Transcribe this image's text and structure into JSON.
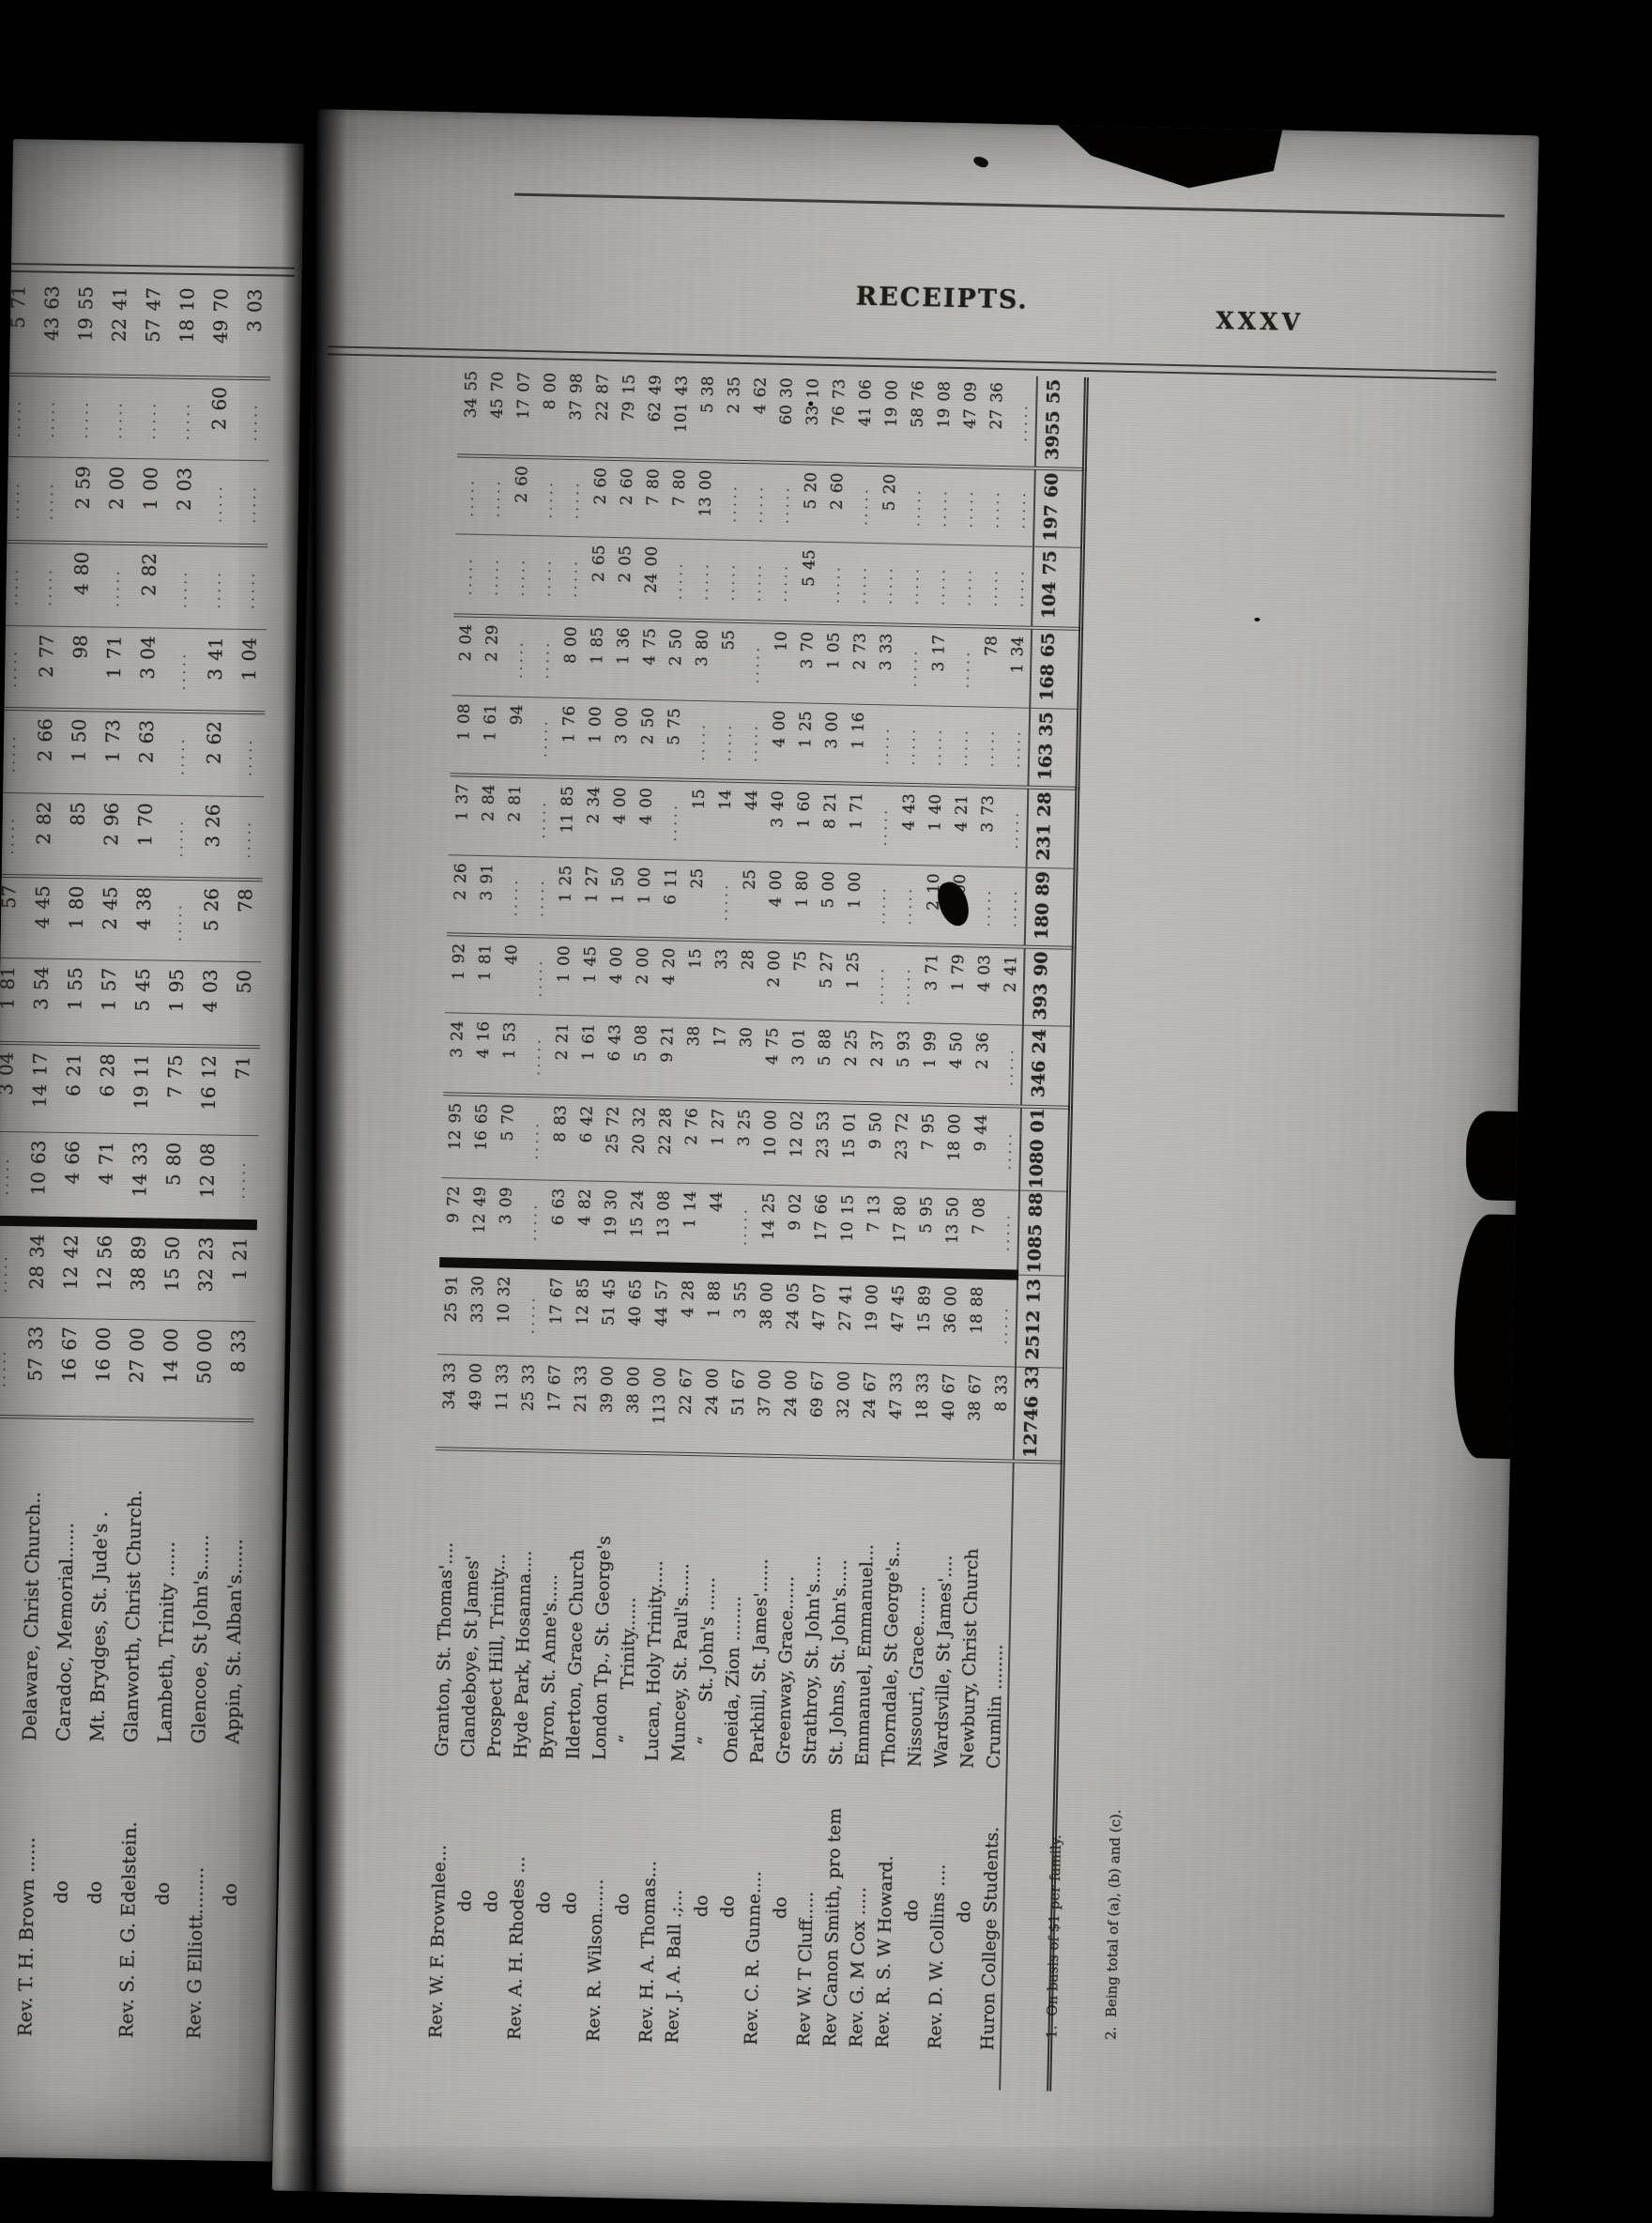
{
  "header": {
    "running_title": "RECEIPTS.",
    "folio": "XXXV"
  },
  "colors": {
    "paper": "#b3b2ae",
    "ink": "#29241e",
    "background": "#020202",
    "heavy_bar": "#12100c"
  },
  "right_page": {
    "rows": [
      {
        "clergy": "Rev. W. F. Brownlee...",
        "church": "Granton, St. Thomas'....",
        "values": [
          "34 33",
          "25 91",
          "9 72",
          "12 95",
          "3 24",
          "1 92",
          "2 26",
          "1 37",
          "1 08",
          "2 04",
          "",
          "",
          "34 55"
        ]
      },
      {
        "clergy": "do",
        "church": "Clandeboye, St James'",
        "values": [
          "49 00",
          "33 30",
          "12 49",
          "16 65",
          "4 16",
          "1 81",
          "3 91",
          "2 84",
          "1 61",
          "2 29",
          "",
          "",
          "45 70"
        ]
      },
      {
        "clergy": "do",
        "church": "Prospect Hill, Trinity...",
        "values": [
          "11 33",
          "10 32",
          "3 09",
          "5 70",
          "1 53",
          "40",
          "",
          "2 81",
          "94",
          "",
          "",
          "2 60",
          "17 07"
        ]
      },
      {
        "clergy": "Rev. A. H. Rhodes ...",
        "church": "Hyde Park, Hosanna....",
        "values": [
          "25 33",
          "",
          "",
          "",
          "",
          "",
          "",
          "",
          "",
          "",
          "",
          "",
          "8 00"
        ]
      },
      {
        "clergy": "do",
        "church": "Byron, St. Anne's.....",
        "values": [
          "17 67",
          "17 67",
          "6 63",
          "8 83",
          "2 21",
          "1 00",
          "1 25",
          "11 85",
          "1 76",
          "8 00",
          "",
          "",
          "37 98"
        ]
      },
      {
        "clergy": "do",
        "church": "Ilderton, Grace Church",
        "values": [
          "21 33",
          "12 85",
          "4 82",
          "6 42",
          "1 61",
          "1 45",
          "1 27",
          "2 34",
          "1 00",
          "1 85",
          "2 65",
          "2 60",
          "22 87"
        ]
      },
      {
        "clergy": "Rev. R. Wilson......",
        "church": "London Tp., St. George's",
        "values": [
          "39 00",
          "51 45",
          "19 30",
          "25 72",
          "6 43",
          "4 00",
          "1 50",
          "4 00",
          "3 00",
          "1 36",
          "2 05",
          "2 60",
          "79 15"
        ]
      },
      {
        "clergy": "do",
        "church": "   “        Trinity......",
        "values": [
          "38 00",
          "40 65",
          "15 24",
          "20 32",
          "5 08",
          "2 00",
          "1 00",
          "4 00",
          "2 50",
          "4 75",
          "24 00",
          "7 80",
          "62 49"
        ]
      },
      {
        "clergy": "Rev. H. A. Thomas...",
        "church": "Lucan, Holy Trinity.....",
        "values": [
          "113 00",
          "44 57",
          "13 08",
          "22 28",
          "9 21",
          "4 20",
          "6 11",
          "",
          "5 75",
          "2 50",
          "",
          "7 80",
          "101 43"
        ]
      },
      {
        "clergy": "Rev. J. A. Ball .;...",
        "church": "Muncey, St. Paul's......",
        "values": [
          "22 67",
          "4 28",
          "1 14",
          "2 76",
          "38",
          "15",
          "25",
          "15",
          "",
          "3 80",
          "",
          "13 00",
          "5 38"
        ]
      },
      {
        "clergy": "do",
        "church": "   “      St. John's ......",
        "values": [
          "24 00",
          "1 88",
          "44",
          "1 27",
          "17",
          "33",
          "",
          "14",
          "",
          "55",
          "",
          "",
          "2 35"
        ]
      },
      {
        "clergy": "do",
        "church": "Oneida, Zion ........",
        "values": [
          "51 67",
          "3 55",
          "",
          "3 25",
          "30",
          "28",
          "25",
          "44",
          "",
          "",
          "",
          "",
          "4 62"
        ]
      },
      {
        "clergy": "Rev. C. R. Gunne....",
        "church": "Parkhill, St. James'......",
        "values": [
          "37 00",
          "38 00",
          "14 25",
          "10 00",
          "4 75",
          "2 00",
          "4 00",
          "3 40",
          "4 00",
          "10",
          "",
          "",
          "60 30"
        ]
      },
      {
        "clergy": "do",
        "church": "Greenway, Grace......",
        "values": [
          "24 00",
          "24 05",
          "9 02",
          "12 02",
          "3 01",
          "75",
          "1 80",
          "1 60",
          "1 25",
          "3 70",
          "5 45",
          "5 20",
          "33 10"
        ]
      },
      {
        "clergy": "Rev W. T Cluff.....",
        "church": "Strathroy, St. John's.....",
        "values": [
          "69 67",
          "47 07",
          "17 66",
          "23 53",
          "5 88",
          "5 27",
          "5 00",
          "8 21",
          "3 00",
          "1 05",
          "",
          "2 60",
          "76 73"
        ]
      },
      {
        "clergy": "Rev Canon Smith, pro tem",
        "church": "St. Johns, St. John's.....",
        "values": [
          "32 00",
          "27 41",
          "10 15",
          "15 01",
          "2 25",
          "1 25",
          "1 00",
          "1 71",
          "1 16",
          "2 73",
          "",
          "",
          "41 06"
        ]
      },
      {
        "clergy": "Rev. G. M Cox .....",
        "church": "Emmanuel, Emmanuel...",
        "values": [
          "24 67",
          "19 00",
          "7 13",
          "9 50",
          "2 37",
          "",
          "",
          "",
          "",
          "3 33",
          "",
          "5 20",
          "19 00"
        ]
      },
      {
        "clergy": "Rev. R. S. W Howard.",
        "church": "Thorndale, St George's...",
        "values": [
          "47 33",
          "47 45",
          "17 80",
          "23 72",
          "5 93",
          "",
          "",
          "4 43",
          "",
          "",
          "",
          "",
          "58 76"
        ]
      },
      {
        "clergy": "do",
        "church": "Nissouri, Grace.......",
        "values": [
          "18 33",
          "15 89",
          "5 95",
          "7 95",
          "1 99",
          "3 71",
          "2 10",
          "1 40",
          "",
          "3 17",
          "",
          "",
          "19 08"
        ]
      },
      {
        "clergy": "Rev. D. W. Collins ....",
        "church": "Wardsville, St James'....",
        "values": [
          "40 67",
          "36 00",
          "13 50",
          "18 00",
          "4 50",
          "1 79",
          "2 00",
          "4 21",
          "",
          "",
          "",
          "",
          "47 09"
        ]
      },
      {
        "clergy": "do",
        "church": "Newbury, Christ Church",
        "values": [
          "38 67",
          "18 88",
          "7 08",
          "9 44",
          "2 36",
          "4 03",
          "",
          "3 73",
          "",
          "78",
          "",
          "",
          "27 36"
        ]
      },
      {
        "clergy": "Huron College Students.",
        "church": "Crumlin ........",
        "values": [
          "8 33",
          "",
          "",
          "",
          "",
          "2 41",
          "",
          "",
          "",
          "1 34",
          "",
          "",
          ""
        ]
      }
    ],
    "totals": [
      "12746 33",
      "2512 13",
      "1085 88",
      "1080 01",
      "346 24",
      "393 90",
      "180 89",
      "231 28",
      "163 35",
      "168 65",
      "104 75",
      "197 60",
      "3955 55"
    ],
    "footnotes": [
      "1.  On basis of $1 per family.",
      "2.  Being total of (a), (b) and (c)."
    ]
  },
  "left_page": {
    "rows": [
      {
        "clergy": "",
        "church": "",
        "values": [
          "",
          "",
          "",
          "3 04",
          "1 81",
          "57",
          "",
          "",
          "",
          "",
          "",
          "",
          "5 71"
        ]
      },
      {
        "clergy": "Rev. T. H. Brown ......",
        "church": "Delaware, Christ Church..",
        "values": [
          "57 33",
          "28 34",
          "10 63",
          "14 17",
          "3 54",
          "4 45",
          "2 82",
          "2 66",
          "2 77",
          "",
          "",
          "",
          "43 63"
        ]
      },
      {
        "clergy": "do",
        "church": "Caradoc, Memorial......",
        "values": [
          "16 67",
          "12 42",
          "4 66",
          "6 21",
          "1 55",
          "1 80",
          "85",
          "1 50",
          "98",
          "4 80",
          "2 59",
          "",
          "19 55"
        ]
      },
      {
        "clergy": "do",
        "church": "Mt. Brydges, St. Jude's .",
        "values": [
          "16 00",
          "12 56",
          "4 71",
          "6 28",
          "1 57",
          "2 45",
          "2 96",
          "1 73",
          "1 71",
          "",
          "2 00",
          "",
          "22 41"
        ]
      },
      {
        "clergy": "Rev. S. E. G. Edelstein.",
        "church": "Glanworth, Christ Church.",
        "values": [
          "27 00",
          "38 89",
          "14 33",
          "19 11",
          "5 45",
          "4 38",
          "1 70",
          "2 63",
          "3 04",
          "2 82",
          "1 00",
          "",
          "57 47"
        ]
      },
      {
        "clergy": "do",
        "church": "Lambeth, Trinity ......",
        "values": [
          "14 00",
          "15 50",
          "5 80",
          "7 75",
          "1 95",
          "",
          "",
          "",
          "",
          "",
          "2 03",
          "",
          "18 10"
        ]
      },
      {
        "clergy": "Rev. G Elliott........",
        "church": "Glencoe, St John's......",
        "values": [
          "50 00",
          "32 23",
          "12 08",
          "16 12",
          "4 03",
          "5 26",
          "3 26",
          "2 62",
          "3 41",
          "",
          "",
          "2 60",
          "49 70"
        ]
      },
      {
        "clergy": "do",
        "church": "Appin, St. Alban's......",
        "values": [
          "8 33",
          "1 21",
          "",
          "71",
          "50",
          "78",
          "",
          "",
          "1 04",
          "",
          "",
          "",
          "3 03"
        ]
      }
    ]
  }
}
